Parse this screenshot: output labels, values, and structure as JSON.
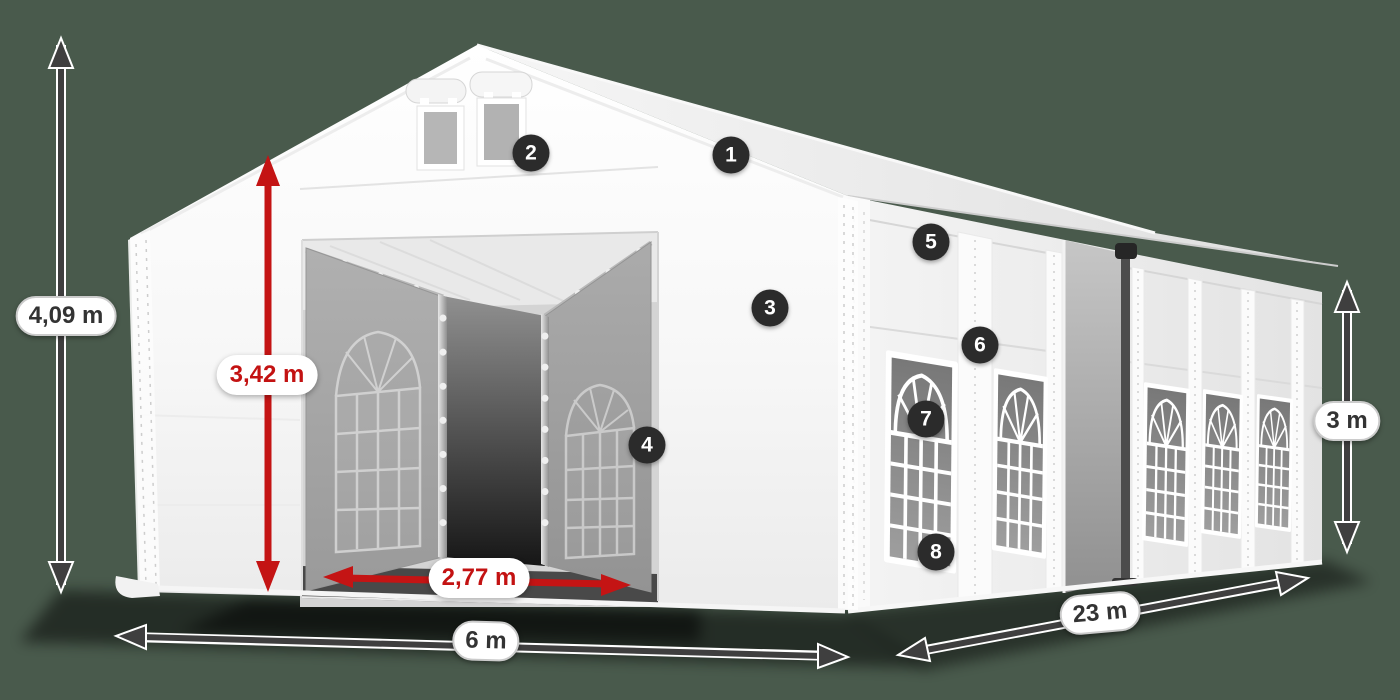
{
  "colors": {
    "background": "#495a4c",
    "accent_red": "#c41414",
    "arrow_gray": "#3f3f3f",
    "marker_background": "#2b2b2b",
    "marker_text": "#ffffff",
    "label_text": "#333333",
    "label_border": "#cbcbcb",
    "tent_white": "#ffffff"
  },
  "dimensions": {
    "total_height": {
      "label": "4,09 m",
      "style": "gray"
    },
    "entrance_height": {
      "label": "3,42 m",
      "style": "red"
    },
    "entrance_width": {
      "label": "2,77 m",
      "style": "red"
    },
    "front_width": {
      "label": "6 m",
      "style": "gray"
    },
    "side_length": {
      "label": "23 m",
      "style": "gray"
    },
    "wall_height": {
      "label": "3 m",
      "style": "gray"
    }
  },
  "markers": [
    {
      "n": "1"
    },
    {
      "n": "2"
    },
    {
      "n": "3"
    },
    {
      "n": "4"
    },
    {
      "n": "5"
    },
    {
      "n": "6"
    },
    {
      "n": "7"
    },
    {
      "n": "8"
    }
  ]
}
